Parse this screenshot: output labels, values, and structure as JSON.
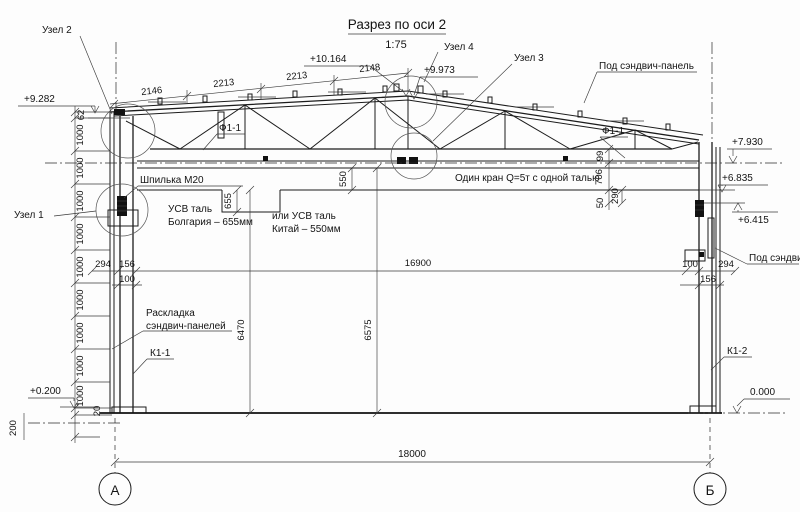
{
  "title": {
    "text": "Разрез по оси 2",
    "scale": "1:75"
  },
  "axes": {
    "left": "А",
    "right": "Б"
  },
  "elevations": {
    "apex": "+10.164",
    "ridge_low": "+9.973",
    "left_eave": "+9.282",
    "right_top": "+7.930",
    "right_ceiling": "+6.835",
    "right_bracket": "+6.415",
    "base": "+0.200",
    "zero": "0.000"
  },
  "labels": {
    "uzel1": "Узел 1",
    "uzel2": "Узел 2",
    "uzel3": "Узел 3",
    "uzel4": "Узел 4",
    "f1_left": "Ф1-1",
    "f1_right": "Ф1-1",
    "sandwich_top": "Под сэндвич-панель",
    "sandwich_right": "Под сэндвич",
    "stud": "Шпилька М20",
    "hoist_bg_line1": "УСВ таль",
    "hoist_bg_line2": "Болгария – 655мм",
    "hoist_cn_line1": "или УСВ таль",
    "hoist_cn_line2": "Китай – 550мм",
    "crane": "Один кран Q=5т с одной талью",
    "layout_line1": "Раскладка",
    "layout_line2": "сэндвич-панелей",
    "k1_1": "К1-1",
    "k1_2": "К1-2"
  },
  "dims": {
    "slope": [
      "2146",
      "2213",
      "2213",
      "2148"
    ],
    "left_62": "62",
    "left_1000": [
      "1000",
      "1000",
      "1000",
      "1000",
      "1000",
      "1000",
      "1000",
      "1000",
      "1000"
    ],
    "left_20": "20",
    "left_200": "200",
    "left_294": "294",
    "left_156": "156",
    "left_100": "100",
    "right_100": "100",
    "right_294": "294",
    "right_156": "156",
    "v_655": "655",
    "v_550": "550",
    "v_6470": "6470",
    "v_6575": "6575",
    "r_99": "99",
    "r_706": "706",
    "r_50": "50",
    "r_290": "290",
    "span_16900": "16900",
    "span_18000": "18000"
  }
}
